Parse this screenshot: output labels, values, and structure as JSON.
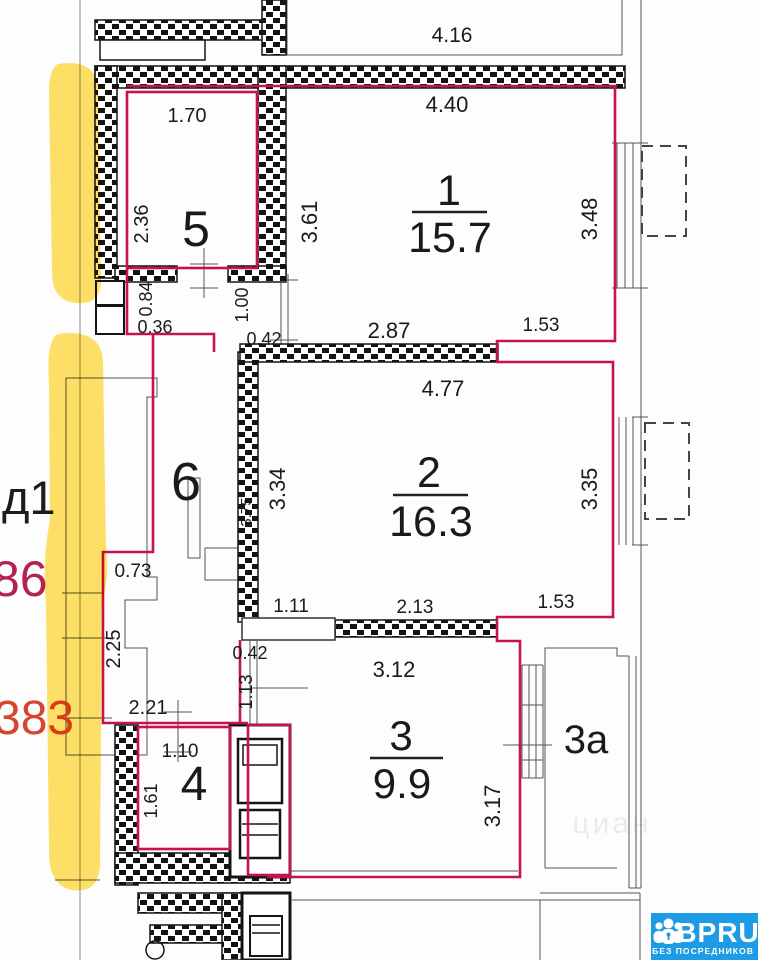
{
  "plan": {
    "rooms": {
      "r1": {
        "num": "1",
        "area": "15.7"
      },
      "r2": {
        "num": "2",
        "area": "16.3"
      },
      "r3": {
        "num": "3",
        "area": "9.9"
      },
      "r3a": {
        "num": "3а"
      },
      "r4": {
        "num": "4"
      },
      "r5": {
        "num": "5"
      },
      "r6": {
        "num": "6"
      }
    },
    "dims": {
      "d416": "4.16",
      "d440": "4.40",
      "d170": "1.70",
      "d236": "2.36",
      "d361": "3.61",
      "d348": "3.48",
      "d084": "0.84",
      "d036": "0.36",
      "d100": "1.00",
      "d042a": "0.42",
      "d287": "2.87",
      "d153a": "1.53",
      "d477": "4.77",
      "d334": "3.34",
      "d375": "3.75",
      "d335": "3.35",
      "d111": "1.11",
      "d213": "2.13",
      "d153b": "1.53",
      "d073": "0.73",
      "d225": "2.25",
      "d221": "2.21",
      "d042b": "0.42",
      "d113": "1.13",
      "d312": "3.12",
      "d110": "1.10",
      "d161": "1.61",
      "d317": "3.17"
    },
    "side_notes": {
      "entrance": "д1",
      "note86": "86",
      "note383": "383"
    },
    "watermark": "циан"
  },
  "logo": {
    "brand": "BPRU",
    "tagline": "БЕЗ ПОСРЕДНИКОВ"
  },
  "colors": {
    "boundary": "#c5134b",
    "highlight": "#ffd93e",
    "note86": "#b3234d",
    "note383": "#d6452c",
    "logo_blue": "#1d9be4"
  }
}
